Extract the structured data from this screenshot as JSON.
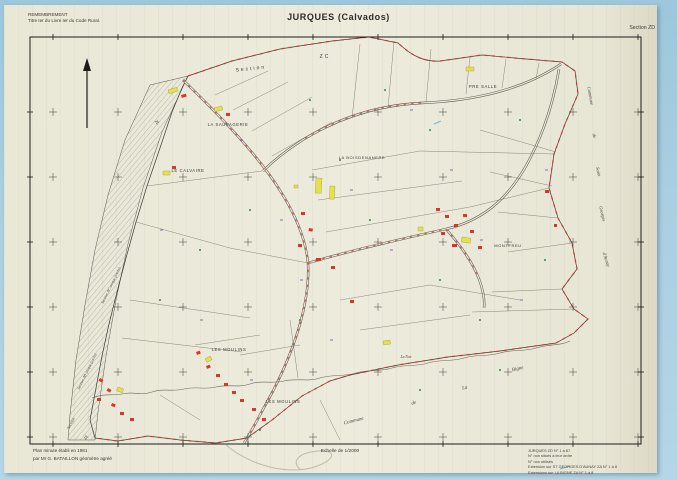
{
  "header": {
    "org_line1": "REMEMBREMENT",
    "org_line2": "Titre Ier du Livre Ier du Code Rural.",
    "title": "JURQUES (Calvados)",
    "section": "Section ZD"
  },
  "footer": {
    "left_line1": "Plan minute établi en 1981",
    "left_line2": "par Mr G. BATAILLON géomètre agréé",
    "scale": "Echelle de 1/2000",
    "notes": [
      "JURQUES ZD N° 1 à 87",
      "N° non situés à leur ordre",
      "N° non utilisés",
      "Extension sur ST GEORGES D'AUNAY ZA N° 1 à 8",
      "Extensions sur LA BIGNE ZA N° 1 à 8"
    ]
  },
  "map": {
    "labels": [
      {
        "t": "Section",
        "x": 251,
        "y": 70,
        "r": -6,
        "s": 5,
        "c": "sec"
      },
      {
        "t": "ZC",
        "x": 325,
        "y": 58,
        "r": 0,
        "s": 5,
        "c": "sec"
      },
      {
        "t": "ZL",
        "x": 156,
        "y": 123,
        "r": 55,
        "s": 4.5,
        "c": "ital"
      },
      {
        "t": "LA SAUVAGERIE",
        "x": 228,
        "y": 126,
        "r": 0,
        "s": 4.2,
        "c": "cap"
      },
      {
        "t": "LE CALVAIRE",
        "x": 188,
        "y": 172,
        "r": 0,
        "s": 4.2,
        "c": "cap"
      },
      {
        "t": "LA BOISDENANERE",
        "x": 362,
        "y": 159,
        "r": 0,
        "s": 4,
        "c": "cap"
      },
      {
        "t": "PRE SALLE",
        "x": 483,
        "y": 88,
        "r": 0,
        "s": 4.2,
        "c": "cap"
      },
      {
        "t": "MONTFREU",
        "x": 508,
        "y": 247,
        "r": 0,
        "s": 4,
        "c": "cap"
      },
      {
        "t": "LES MOULINS",
        "x": 229,
        "y": 351,
        "r": 0,
        "s": 4.2,
        "c": "cap"
      },
      {
        "t": "LES MOULINS",
        "x": 283,
        "y": 403,
        "r": 0,
        "s": 4.2,
        "c": "cap"
      },
      {
        "t": "La Noe",
        "x": 406,
        "y": 358,
        "r": 0,
        "s": 3.8,
        "c": "ital"
      },
      {
        "t": "Commune",
        "x": 589,
        "y": 96,
        "r": 80,
        "s": 4.6,
        "c": "ital"
      },
      {
        "t": "de",
        "x": 593,
        "y": 136,
        "r": 80,
        "s": 4.6,
        "c": "ital"
      },
      {
        "t": "Saint",
        "x": 597,
        "y": 172,
        "r": 78,
        "s": 4.6,
        "c": "ital"
      },
      {
        "t": "Georges",
        "x": 601,
        "y": 214,
        "r": 76,
        "s": 4.6,
        "c": "ital"
      },
      {
        "t": "d'Aunay",
        "x": 605,
        "y": 260,
        "r": 72,
        "s": 4.6,
        "c": "ital"
      },
      {
        "t": "Commune",
        "x": 354,
        "y": 422,
        "r": -14,
        "s": 5,
        "c": "ital"
      },
      {
        "t": "de",
        "x": 414,
        "y": 404,
        "r": -14,
        "s": 5,
        "c": "ital"
      },
      {
        "t": "La",
        "x": 465,
        "y": 389,
        "r": -10,
        "s": 5,
        "c": "ital"
      },
      {
        "t": "Bigne",
        "x": 518,
        "y": 370,
        "r": -12,
        "s": 5,
        "c": "ital"
      },
      {
        "t": "Section AC unique (exclu)",
        "x": 112,
        "y": 286,
        "r": -64,
        "s": 3.8,
        "c": "ital"
      },
      {
        "t": "Section AB unique (exclu)",
        "x": 88,
        "y": 372,
        "r": -64,
        "s": 3.8,
        "c": "ital"
      },
      {
        "t": "Section",
        "x": 72,
        "y": 424,
        "r": -62,
        "s": 4.2,
        "c": "ital"
      },
      {
        "t": "ZE",
        "x": 87,
        "y": 438,
        "r": -62,
        "s": 4.2,
        "c": "ital"
      }
    ]
  },
  "colors": {
    "paper": "#e9e7d6",
    "scanner_blue": "#a9cfe0",
    "boundary_red": "#d8382a",
    "building_yellow": "#e6e04a",
    "vegetation_green": "#2e8b3a",
    "parcel_violet": "#8a5ab8",
    "ink": "#3a3a38"
  }
}
